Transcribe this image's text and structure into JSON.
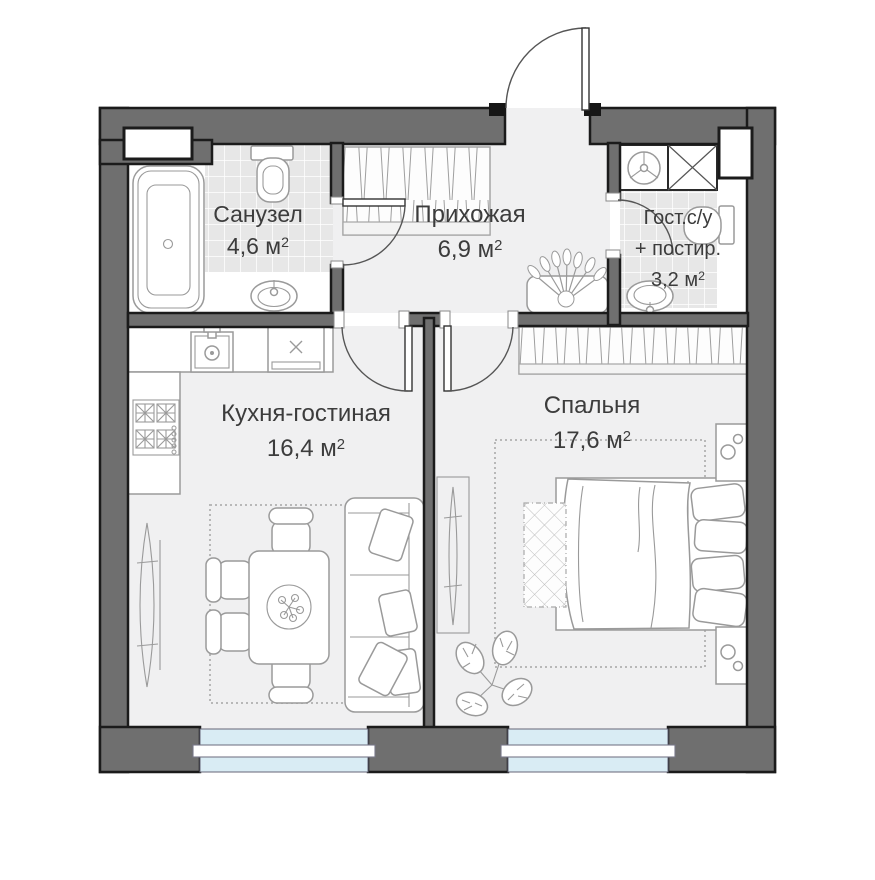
{
  "units": {
    "unit": "м",
    "sup": "2"
  },
  "rooms": [
    {
      "id": "sanuzel",
      "name": "Санузел",
      "area": "4,6"
    },
    {
      "id": "prihozhaya",
      "name": "Прихожая",
      "area": "6,9"
    },
    {
      "id": "gost-su",
      "name": "Гост.с/у",
      "name2": "+ постир.",
      "area": "3,2"
    },
    {
      "id": "kitchen",
      "name": "Кухня-гостиная",
      "area": "16,4"
    },
    {
      "id": "bedroom",
      "name": "Спальня",
      "area": "17,6"
    }
  ],
  "colors": {
    "wall": "#6f6f6f",
    "ink": "#1b1b1b",
    "floor": "#f0f0f1",
    "tile": "#e7e7e7",
    "glass": "#d9ecf4",
    "fo": "#9a9a9a",
    "text": "#3c3c3c",
    "bg": "#ffffff"
  },
  "furniture": [
    "bathtub",
    "toilet",
    "bathroom-sink",
    "washing-machine",
    "ventilation-shaft",
    "wardrobe",
    "bed",
    "bench",
    "nightstand",
    "sofa",
    "dining-table",
    "chair",
    "stove",
    "oven",
    "kitchen-sink",
    "floor-mirror",
    "plant",
    "rug",
    "window",
    "door"
  ]
}
